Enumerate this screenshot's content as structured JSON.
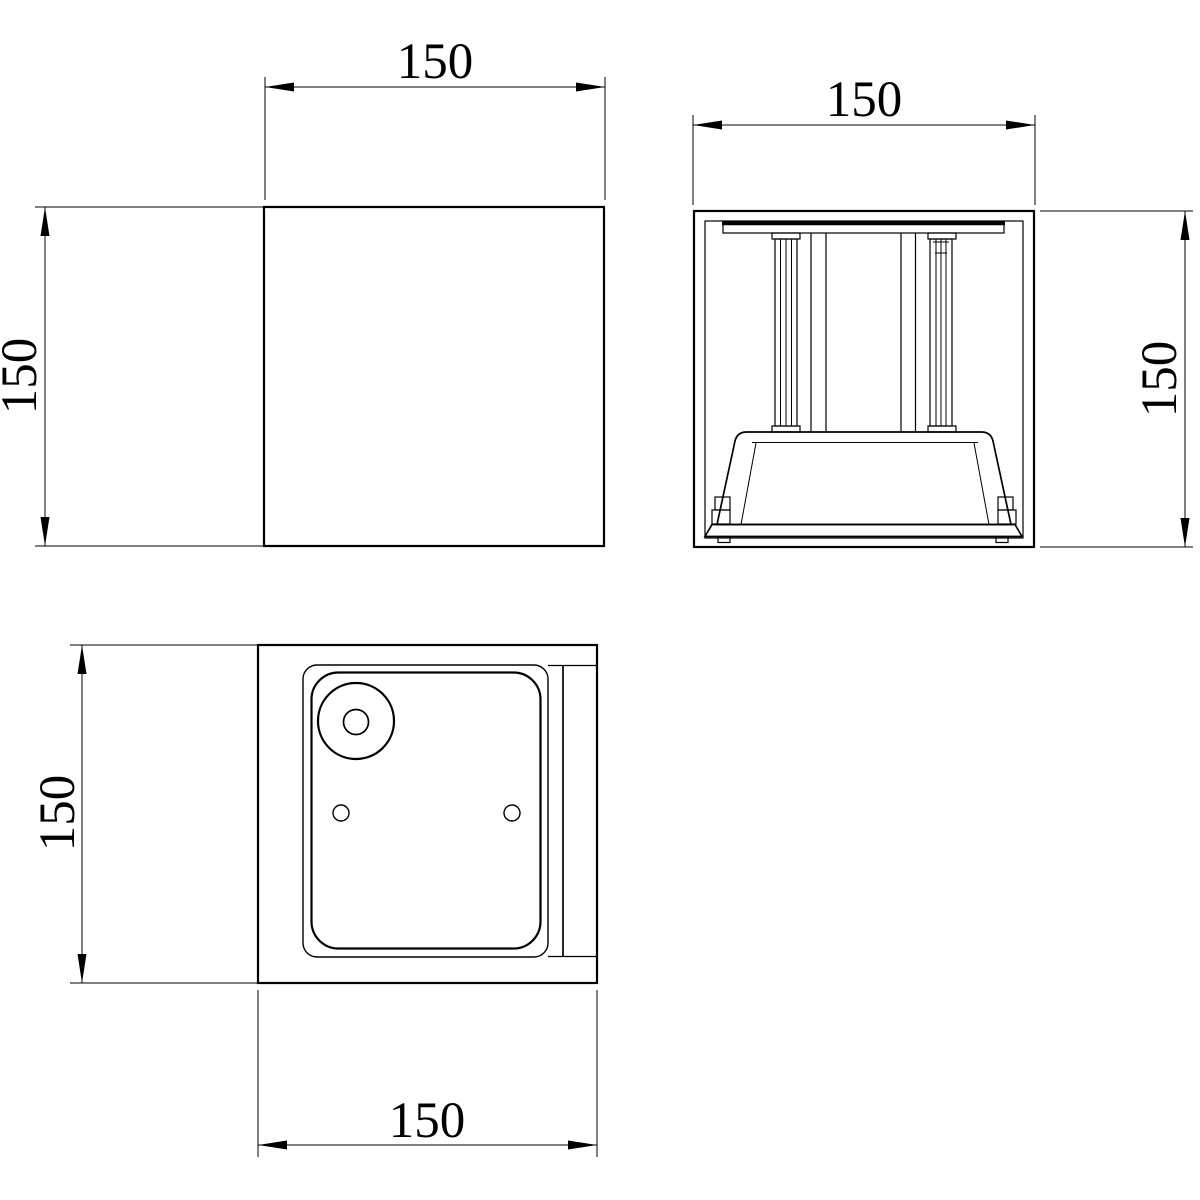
{
  "colors": {
    "line": "#000000",
    "background": "#ffffff"
  },
  "dimensions": {
    "front": {
      "width": "150",
      "height": "150"
    },
    "section": {
      "width": "150",
      "height": "150"
    },
    "bottom": {
      "width": "150",
      "height": "150"
    }
  }
}
